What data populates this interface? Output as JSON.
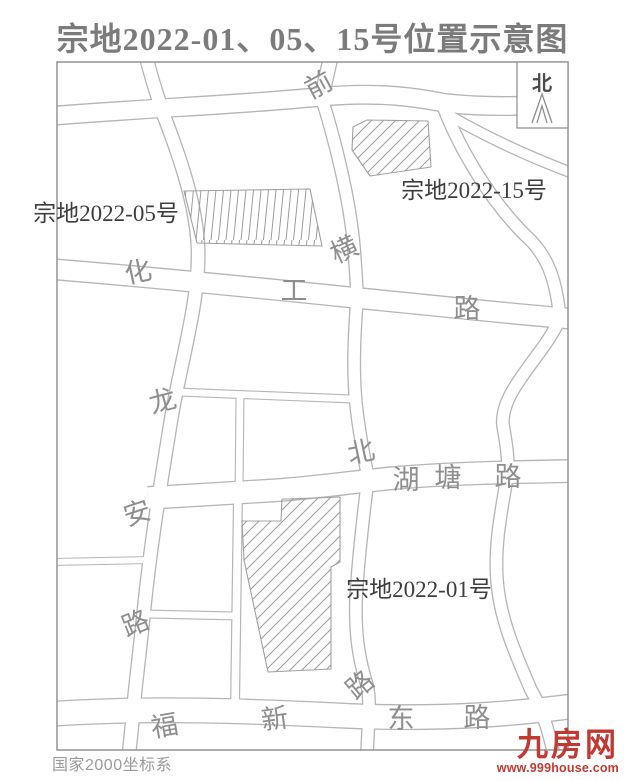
{
  "title": "宗地2022-01、05、15号位置示意图",
  "map": {
    "compass_label": "北",
    "coordinate_system": "国家2000坐标系",
    "parcel_labels": [
      {
        "id": "parcel-2022-05",
        "text": "宗地2022-05号",
        "x": 106,
        "y": 221
      },
      {
        "id": "parcel-2022-15",
        "text": "宗地2022-15号",
        "x": 474,
        "y": 198
      },
      {
        "id": "parcel-2022-01",
        "text": "宗地2022-01号",
        "x": 419,
        "y": 597
      }
    ],
    "road_labels": [
      {
        "text": "前",
        "x": 323,
        "y": 93,
        "rot": -28
      },
      {
        "text": "横",
        "x": 348,
        "y": 258,
        "rot": -25
      },
      {
        "text": "化",
        "x": 140,
        "y": 281,
        "rot": -12
      },
      {
        "text": "工",
        "x": 294,
        "y": 300,
        "rot": 0
      },
      {
        "text": "路",
        "x": 467,
        "y": 318,
        "rot": 0
      },
      {
        "text": "龙",
        "x": 165,
        "y": 410,
        "rot": -15
      },
      {
        "text": "安",
        "x": 140,
        "y": 522,
        "rot": -18
      },
      {
        "text": "路",
        "x": 139,
        "y": 632,
        "rot": -22
      },
      {
        "text": "北",
        "x": 363,
        "y": 461,
        "rot": -12
      },
      {
        "text": "湖",
        "x": 406,
        "y": 489,
        "rot": 0
      },
      {
        "text": "塘",
        "x": 448,
        "y": 487,
        "rot": 0
      },
      {
        "text": "路",
        "x": 508,
        "y": 486,
        "rot": 0
      },
      {
        "text": "路",
        "x": 366,
        "y": 692,
        "rot": -40
      },
      {
        "text": "福",
        "x": 166,
        "y": 735,
        "rot": -10
      },
      {
        "text": "新",
        "x": 276,
        "y": 728,
        "rot": -8
      },
      {
        "text": "东",
        "x": 401,
        "y": 728,
        "rot": 0
      },
      {
        "text": "路",
        "x": 477,
        "y": 727,
        "rot": 0
      }
    ]
  },
  "watermark": {
    "logo_text": "九房网",
    "url": "www.999house.com"
  },
  "colors": {
    "road_line": "#b5b5b5",
    "map_border": "#8c8c8c",
    "road_label_gray": "#8e8e8e",
    "parcel_label_dark": "#3d3d3d",
    "title_gray": "#7b7b7b",
    "logo_red": "#c13a32",
    "hatch_gray": "#9b9b9b"
  }
}
